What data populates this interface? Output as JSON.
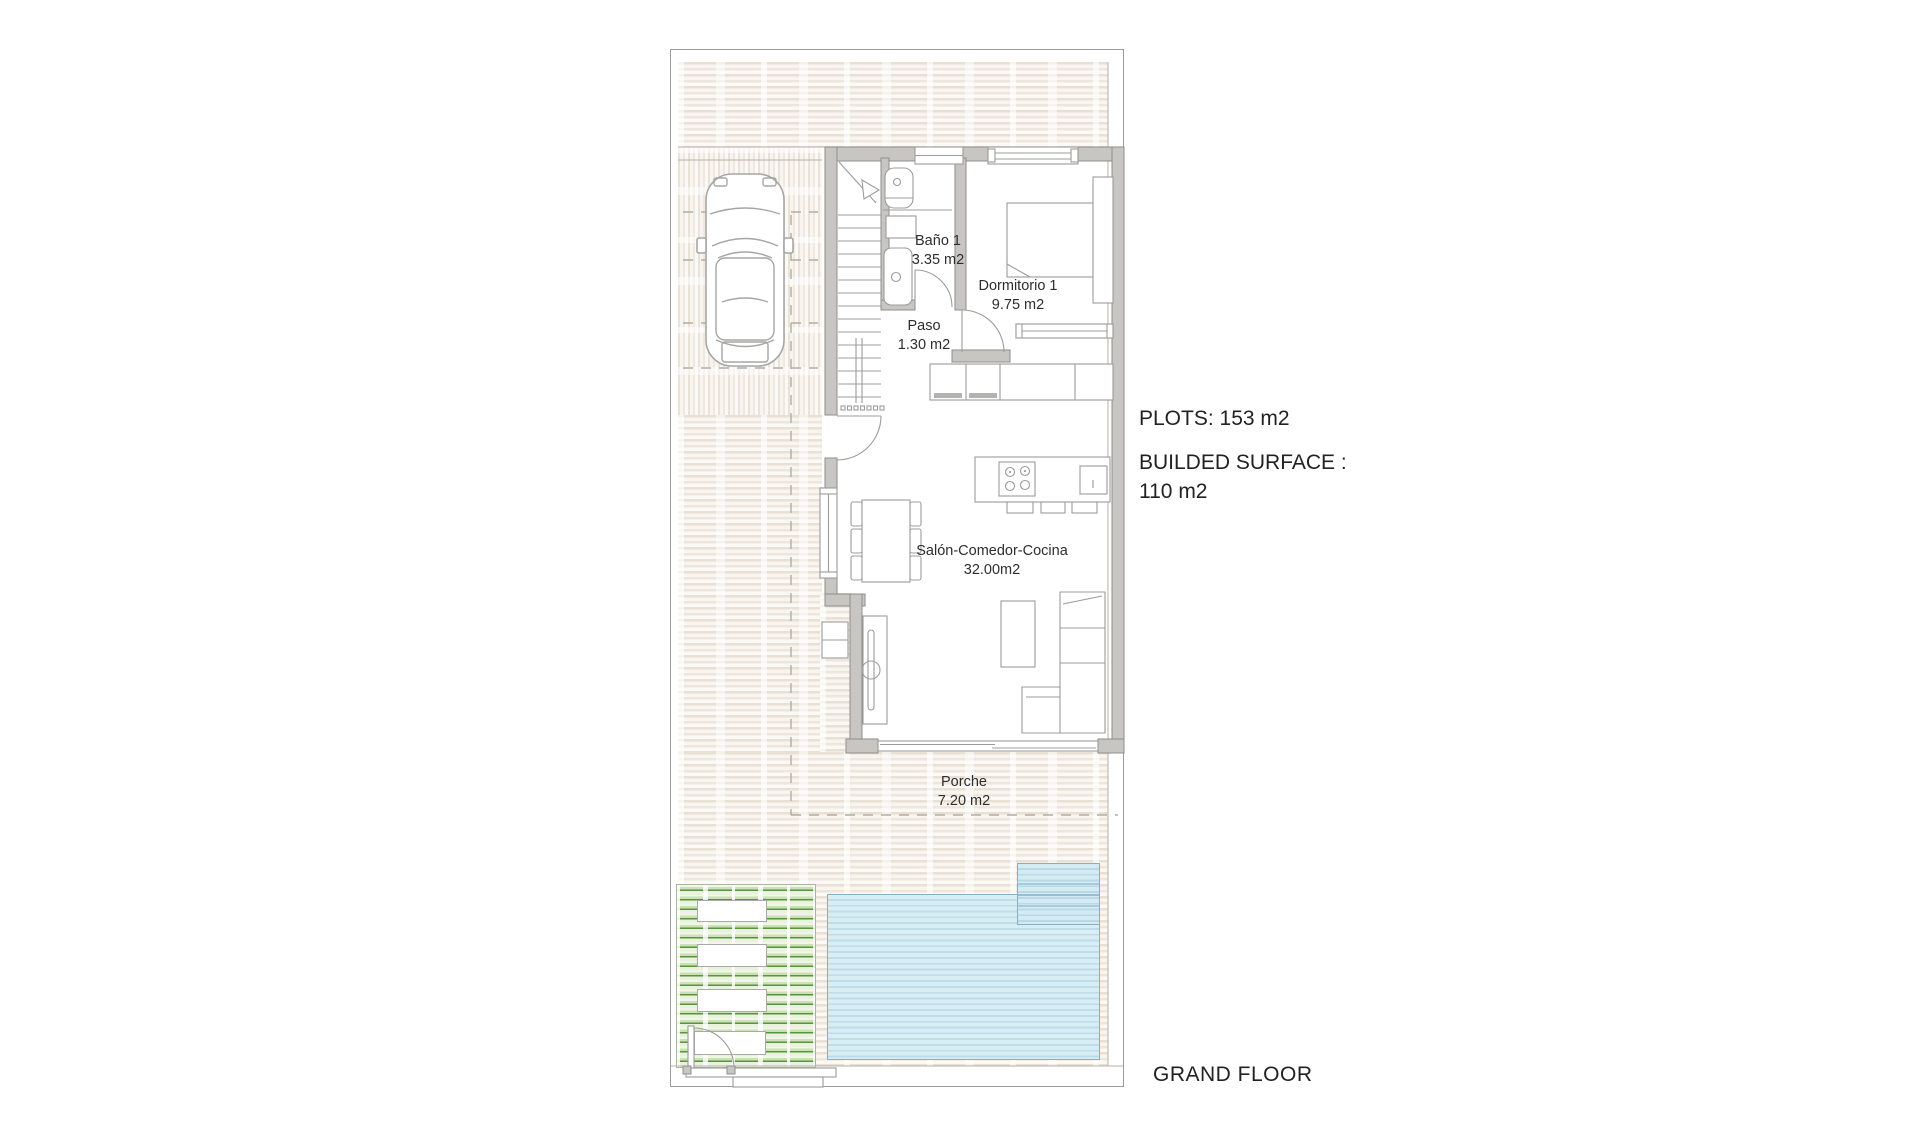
{
  "annotations": {
    "plots": "PLOTS: 153 m2",
    "built_surface_line1": "BUILDED SURFACE :",
    "built_surface_line2": "110 m2",
    "floor_label": "GRAND FLOOR"
  },
  "rooms": {
    "bano": {
      "name": "Baño 1",
      "area": "3.35 m2"
    },
    "dormitorio": {
      "name": "Dormitorio 1",
      "area": "9.75 m2"
    },
    "paso": {
      "name": "Paso",
      "area": "1.30 m2"
    },
    "salon": {
      "name": "Salón-Comedor-Cocina",
      "area": "32.00m2"
    },
    "porche": {
      "name": "Porche",
      "area": "7.20 m2"
    }
  },
  "site": {
    "palm_tree_count": 8,
    "icons": [
      "palm-tree-icon",
      "car-top-view-icon",
      "stairs-icon",
      "bed-icon",
      "sofa-icon",
      "dining-table-icon",
      "kitchen-island-icon",
      "toilet-icon",
      "sink-icon"
    ],
    "colors": {
      "palm_green": "#4f9d33",
      "grass_green": "#58943f",
      "pool_fill": "#d9edf5",
      "pool_stripe": "#bcdde9",
      "pool_border": "#86b0c2",
      "paving_stripe": "#e9e0d5",
      "wall_fill": "#c7c6c3",
      "wall_edge": "#8d8d8b",
      "furniture_line": "#9c9c9a",
      "dash_line": "#b2ada4",
      "text": "#2d2d2d"
    }
  }
}
